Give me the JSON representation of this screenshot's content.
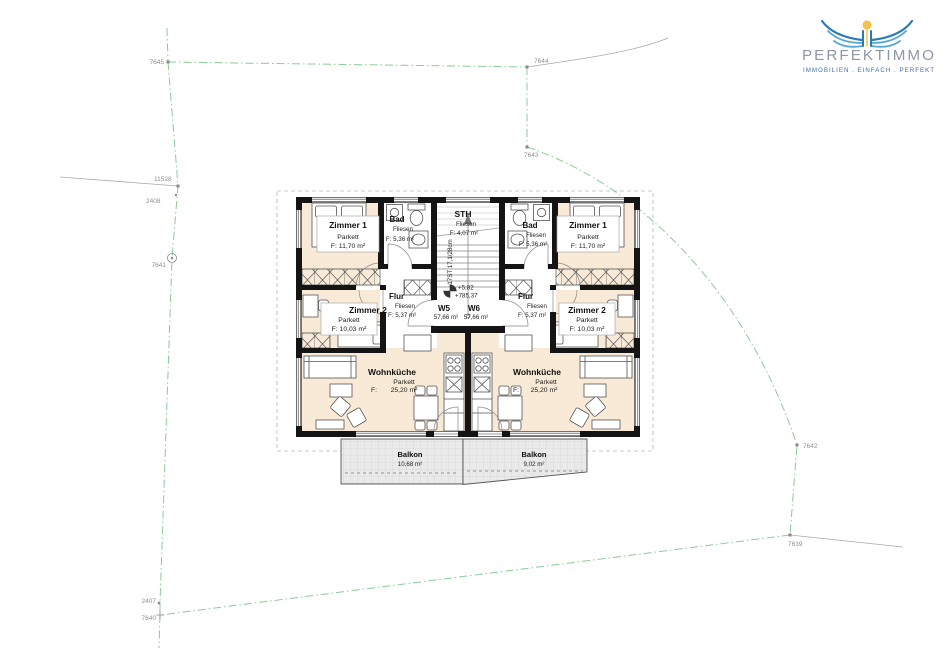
{
  "logo": {
    "brand": "PERFEKTIMMO",
    "tagline": "IMMOBILIEN . EINFACH . PERFEKT",
    "colors": {
      "wing_blue": "#2b7ab6",
      "wing_light": "#5aa7d6",
      "sun_yellow": "#f2c24a",
      "brand_text": "#8e97a6",
      "tagline_text": "#3f6fa9"
    }
  },
  "site_parcels": {
    "7645": "7645",
    "7644": "7644",
    "7643": "7643",
    "7642": "7642",
    "7641": "7641",
    "7640": "7640",
    "7639": "7639",
    "2407": "2407",
    "2408": "2408",
    "11528": "11528"
  },
  "stairwell": {
    "name": "STH",
    "floor": "Fliesen",
    "area": "F: 4,07 m²",
    "stair_note": "17ST 17,1/28cm",
    "level_relative": "+5,82",
    "level_absolute": "+785,37"
  },
  "misc": {
    "f_label": "F:"
  },
  "units": {
    "w5": {
      "label": "W5",
      "area": "57,66 m²",
      "zimmer1": {
        "name": "Zimmer 1",
        "floor": "Parkett",
        "area": "F: 11,70 m²"
      },
      "zimmer2": {
        "name": "Zimmer 2",
        "floor": "Parkett",
        "area": "F: 10,03 m²"
      },
      "bad": {
        "name": "Bad",
        "floor": "Fliesen",
        "area": "F: 5,36 m²"
      },
      "flur": {
        "name": "Flur",
        "floor": "Fliesen",
        "area": "F: 5,37 m²"
      },
      "wohnkueche": {
        "name": "Wohnküche",
        "floor": "Parkett",
        "area": "25,20 m²"
      },
      "balkon": {
        "name": "Balkon",
        "area": "10,68 m²"
      }
    },
    "w6": {
      "label": "W6",
      "area": "57,66 m²",
      "zimmer1": {
        "name": "Zimmer 1",
        "floor": "Parkett",
        "area": "F: 11,70 m²"
      },
      "zimmer2": {
        "name": "Zimmer 2",
        "floor": "Parkett",
        "area": "F: 10,03 m²"
      },
      "bad": {
        "name": "Bad",
        "floor": "Fliesen",
        "area": "F: 5,36 m²"
      },
      "flur": {
        "name": "Flur",
        "floor": "Fliesen",
        "area": "F: 5,37 m²"
      },
      "wohnkueche": {
        "name": "Wohnküche",
        "floor": "Parkett",
        "area": "25,20 m²"
      },
      "balkon": {
        "name": "Balkon",
        "area": "9,02 m²"
      }
    }
  },
  "plan_colors": {
    "parquet_floor": "#f8ead7",
    "tile_floor": "#ffffff",
    "wall": "#141414",
    "boundary_green": "#8ccb96",
    "balcony_gray": "#eaeaea"
  }
}
